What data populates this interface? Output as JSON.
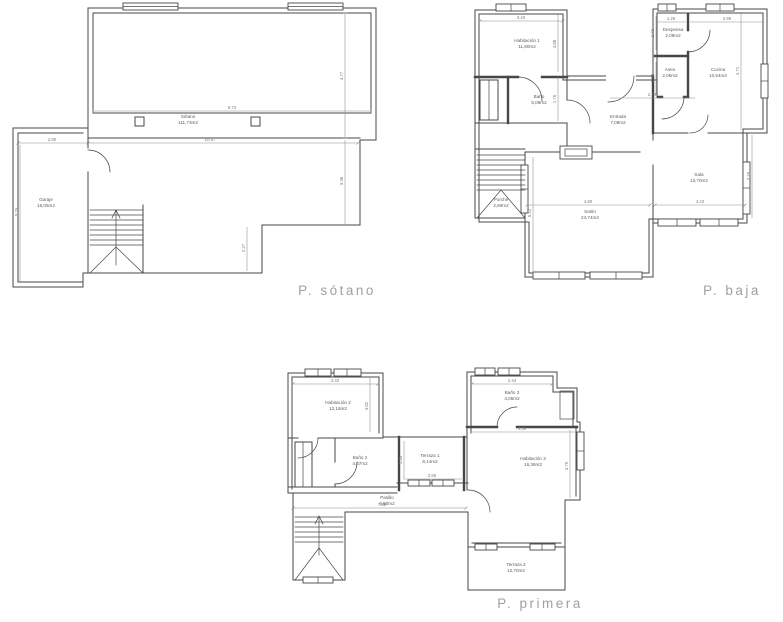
{
  "theme": {
    "background": "#ffffff",
    "wall_color": "#474747",
    "dim_color": "#8a8a8a",
    "dim_label_color": "#7a7a7a",
    "room_label_color": "#5c5c5c",
    "title_color": "#a0a0a0"
  },
  "plans": {
    "sotano": {
      "title": "P. sótano",
      "rooms": [
        {
          "name": "Sótano",
          "area": "111,73m2"
        },
        {
          "name": "Garaje",
          "area": "16,05m2"
        }
      ],
      "dims": [
        "9.73",
        "10.97",
        "2.80",
        "4.77",
        "3.36",
        "2.27",
        "5.25"
      ]
    },
    "baja": {
      "title": "P. baja",
      "rooms": [
        {
          "name": "Habitación 1",
          "area": "11,80m2"
        },
        {
          "name": "Baño",
          "area": "5,08m2"
        },
        {
          "name": "Despensa",
          "area": "2,08m2"
        },
        {
          "name": "Aseo",
          "area": "2,05m2"
        },
        {
          "name": "Cocina",
          "area": "10,54m2"
        },
        {
          "name": "Entrada",
          "area": "7,08m2"
        },
        {
          "name": "Sala",
          "area": "13,70m2"
        },
        {
          "name": "Salón",
          "area": "24,74m2"
        },
        {
          "name": "Porche",
          "area": "2,80m2"
        }
      ],
      "dims": [
        "3.43",
        "1.29",
        "2.96",
        "4.08",
        "1.76",
        "4.71",
        "1.71",
        "1.30",
        "2.74",
        "4.80",
        "4.23",
        "3.75",
        "5.12"
      ]
    },
    "primera": {
      "title": "P. primera",
      "rooms": [
        {
          "name": "Habitación 2",
          "area": "12,16m2"
        },
        {
          "name": "Baño 2",
          "area": "4,07m2"
        },
        {
          "name": "Terraza 1",
          "area": "6,14m2"
        },
        {
          "name": "Baño 3",
          "area": "4,05m2"
        },
        {
          "name": "Habitación 3",
          "area": "16,36m2"
        },
        {
          "name": "Pasillo",
          "area": "6,80m2"
        },
        {
          "name": "Terraza 2",
          "area": "12,70m2"
        }
      ],
      "dims": [
        "3.43",
        "3.02",
        "2.44",
        "1.35",
        "2.66",
        "4.36",
        "4.75",
        "7.25"
      ]
    }
  }
}
